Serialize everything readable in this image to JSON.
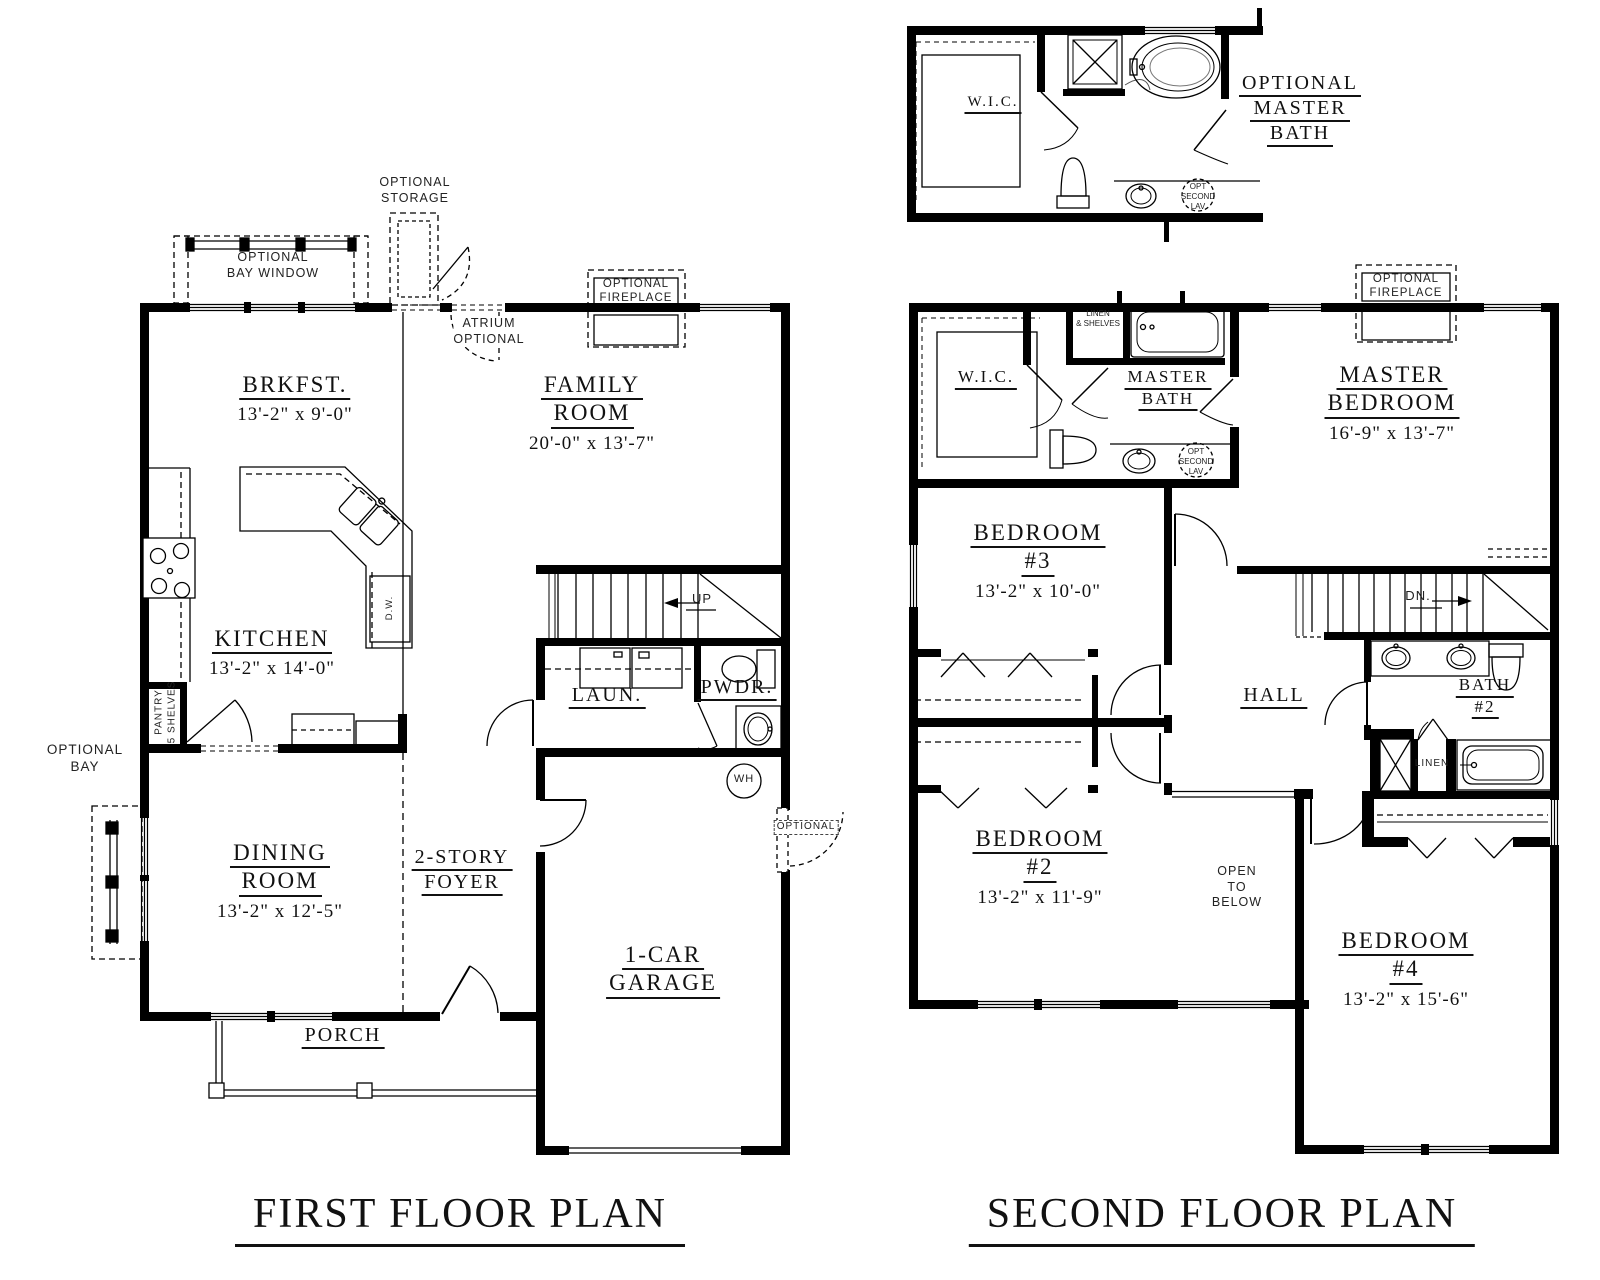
{
  "page": {
    "background": "#ffffff",
    "ink": "#111111"
  },
  "titles": {
    "first_floor": "FIRST FLOOR PLAN",
    "second_floor": "SECOND FLOOR PLAN"
  },
  "first_floor": {
    "rooms": {
      "brkfst": {
        "name": "BRKFST.",
        "dims": "13'-2\" x 9'-0\""
      },
      "family_room": {
        "line1": "FAMILY",
        "line2": "ROOM",
        "dims": "20'-0\" x 13'-7\""
      },
      "kitchen": {
        "name": "KITCHEN",
        "dims": "13'-2\" x 14'-0\""
      },
      "dining_room": {
        "line1": "DINING",
        "line2": "ROOM",
        "dims": "13'-2\" x 12'-5\""
      },
      "foyer": {
        "line1": "2-STORY",
        "line2": "FOYER"
      },
      "garage": {
        "line1": "1-CAR",
        "line2": "GARAGE"
      },
      "laundry": "LAUN.",
      "powder": "PWDR.",
      "porch": "PORCH"
    },
    "annotations": {
      "optional_storage": [
        "OPTIONAL",
        "STORAGE"
      ],
      "optional_bay_window": [
        "OPTIONAL",
        "BAY  WINDOW"
      ],
      "atrium_optional": [
        "ATRIUM",
        "OPTIONAL"
      ],
      "optional_fireplace": [
        "OPTIONAL",
        "FIREPLACE"
      ],
      "optional_bay": [
        "OPTIONAL",
        "BAY"
      ],
      "pantry": [
        "PANTRY",
        "5 SHELVES"
      ],
      "dishwasher": "D.W.",
      "stairs_up": "UP",
      "water_heater": "WH",
      "optional_door": "OPTIONAL"
    }
  },
  "second_floor": {
    "rooms": {
      "master_bedroom": {
        "line1": "MASTER",
        "line2": "BEDROOM",
        "dims": "16'-9\" x 13'-7\""
      },
      "bedroom_3": {
        "line1": "BEDROOM",
        "line2": "#3",
        "dims": "13'-2\" x 10'-0\""
      },
      "bedroom_2": {
        "line1": "BEDROOM",
        "line2": "#2",
        "dims": "13'-2\" x 11'-9\""
      },
      "bedroom_4": {
        "line1": "BEDROOM",
        "line2": "#4",
        "dims": "13'-2\" x 15'-6\""
      },
      "master_bath": {
        "line1": "MASTER",
        "line2": "BATH"
      },
      "bath_2": {
        "line1": "BATH",
        "line2": "#2"
      },
      "wic": "W.I.C.",
      "hall": "HALL"
    },
    "annotations": {
      "linen_shelves": [
        "LINEN",
        "& SHELVES"
      ],
      "linen": "LINEN",
      "stairs_dn": "DN.",
      "open_to_below": [
        "OPEN",
        "TO",
        "BELOW"
      ],
      "optional_fireplace": [
        "OPTIONAL",
        "FIREPLACE"
      ],
      "opt_second_lav": [
        "OPT",
        "SECOND",
        "LAV"
      ]
    }
  },
  "optional_master_bath_inset": {
    "title": [
      "OPTIONAL",
      "MASTER",
      "BATH"
    ],
    "wic": "W.I.C.",
    "opt_second_lav": [
      "OPT",
      "SECOND",
      "LAV"
    ]
  }
}
